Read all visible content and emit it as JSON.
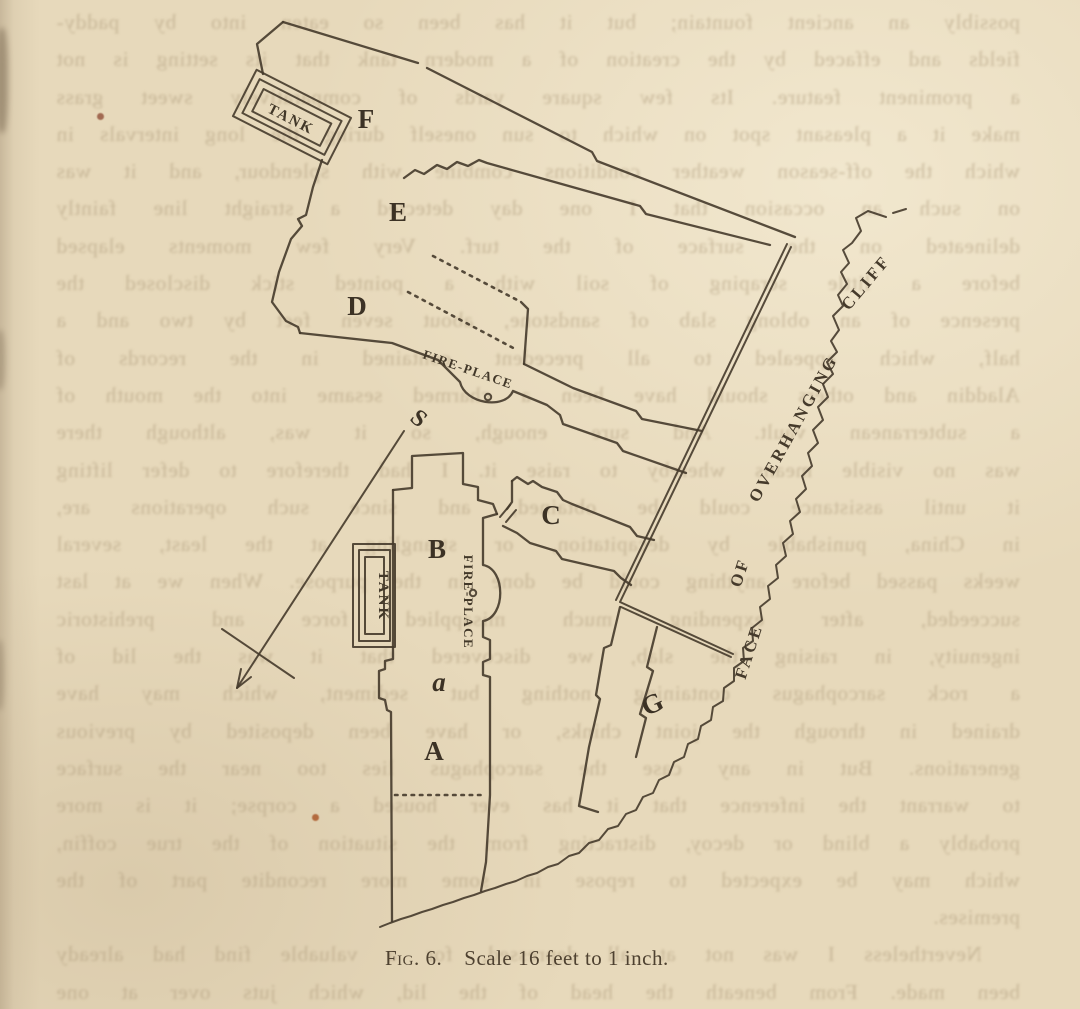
{
  "caption": {
    "fig": "Fig. 6.",
    "scale": "Scale 16 feet to 1 inch."
  },
  "labels": {
    "F": "F",
    "E": "E",
    "D": "D",
    "C": "C",
    "B": "B",
    "A": "A",
    "G": "G",
    "a": "a",
    "S": "S"
  },
  "tanks": {
    "tank1": "TANK",
    "tank2": "TANK"
  },
  "fireplaces": {
    "fp1": "FIRE-PLACE",
    "fp2": "FIRE-PLACE"
  },
  "cliff_label": {
    "w1": "FACE",
    "w2": "OF",
    "w3": "OVERHANGING",
    "w4": "CLIFF"
  },
  "colors": {
    "paper": "#e7d9bb",
    "ink": "#453a2b",
    "ghost": "#ab9878"
  },
  "ghost_text": {
    "legibility": "faint mirrored show-through from reverse page",
    "lines": [
      "possibly an ancient fountain; but it has been so eaten into by paddy-",
      "fields and effaced by the creation of a modern tank that its setting is not",
      "a prominent feature.  Its few square yards of comparatively sweet grass",
      "make it a pleasant spot on which to sun oneself during the long intervals in",
      "which the off-season weather conditions combine with splendour, and it was",
      "on such an occasion that I one day detected a straight line faintly",
      "delineated on the surface of the turf.  Very few moments elapsed",
      "before a little scraping of soil with a pointed stick disclosed the",
      "presence of an oblong slab of sandstone, about seven feet by two and a",
      "half, which appealed to all precedent contained in the records of",
      "Aladdin and others should have been a charmed sesame into the mouth of",
      "a subterranean vault.  And sure enough, so it was, although there",
      "was no visible means whereby to raise it.  I had therefore to defer lifting",
      "it until assistance could be obtained, and since such operations are,",
      "in China, punishable by decapitation, or strangling at the least, several",
      "weeks passed before anything could be done in the purpose.  When we at last",
      "succeeded, after expending much misapplied force and prehistoric",
      "ingenuity, in raising the slab, we discovered that it was the lid of",
      "a rock sarcophagus containing nothing but sediment, which may have",
      "drained in through the joint chinks, or have been deposited by previous",
      "generations.  But in any case the sarcophagus lies too near the surface",
      "to warrant the inference that it has ever housed a corpse; it is more",
      "probably a blind or decoy, distracting from the situation of the true coffin,",
      "which may be expected to repose in some more recondite part of the",
      "premises.",
      "  Nevertheless I was not at all depressed, for a valuable find had already",
      "been made.  From beneath the head of the lid, which juts over at one"
    ]
  }
}
